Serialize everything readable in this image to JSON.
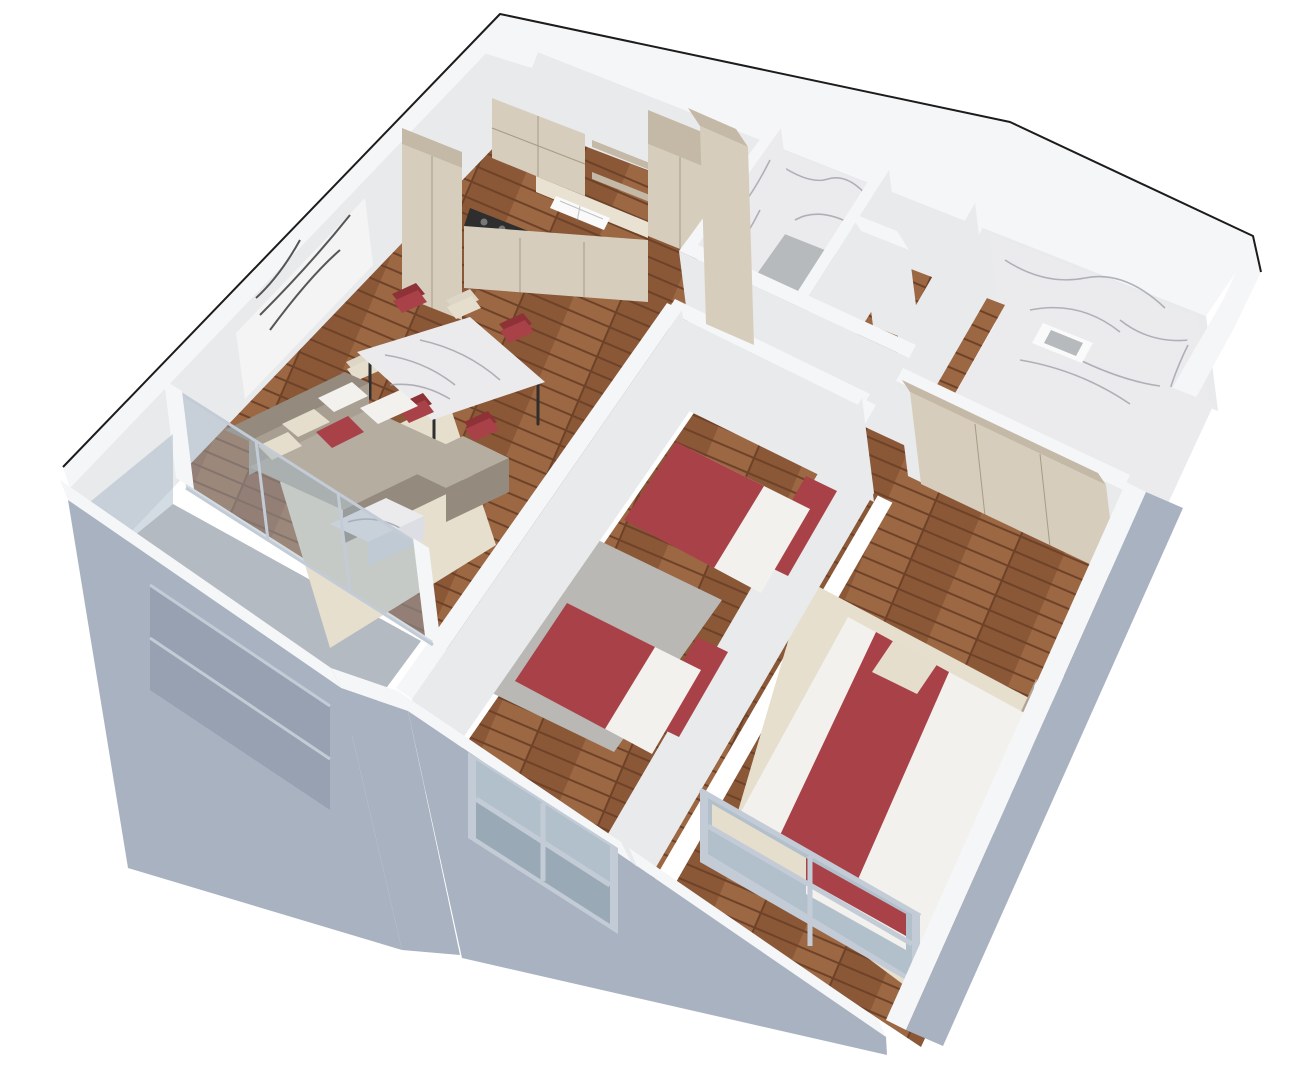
{
  "scene": {
    "title": "3D cutaway floor plan render of a two-bedroom apartment",
    "view": "aerial perspective cutaway, walls cut at ~1.1 m",
    "background": "#ffffff",
    "visible_text": ""
  },
  "palette": {
    "bg": "#ffffff",
    "outline": "#1c1c1c",
    "wall_top": "#f5f6f8",
    "wall_face": "#e9eaec",
    "wall_side": "#dcdee3",
    "facade": "#a9b2c1",
    "facade_shadow": "#97a1b2",
    "glass": "rgba(158,178,192,0.45)",
    "window_frame": "#c3ccd6",
    "wood": "#8a5737",
    "wood2": "#9c6743",
    "wood3": "#6e4228",
    "floor_gray": "#b6babd",
    "concrete": "#b4bac1",
    "marble": "#ebebed",
    "marble_vein": "#9b9ba6",
    "rug_beige": "#e6dfcd",
    "rug_gray": "#b9b8b4",
    "cabinet": "#d7cdbc",
    "cabinet_dark": "#c4b9a6",
    "counter": "#e9e1d2",
    "cream": "#ddd5c6",
    "red": "#a84248",
    "red_dark": "#8e3238",
    "sofa": "#a89f92",
    "sofa_dark": "#948b7e",
    "sofa_light": "#b5ada0",
    "pillow_white": "#f2f1ee",
    "pillow_cream": "#e5decd",
    "bed_frame_taupe": "#b0a394",
    "white_fixture": "#fafafa",
    "black_detail": "#2e2e2e"
  },
  "rooms": [
    {
      "id": "kitchen-living",
      "name": "open plan kitchen / dining / living room",
      "floor": "wood parquet"
    },
    {
      "id": "corridor",
      "name": "corridor",
      "floor": "wood parquet"
    },
    {
      "id": "entry-hall",
      "name": "entry hall",
      "floor": "wood parquet"
    },
    {
      "id": "bathroom-small",
      "name": "small bathroom (WC)",
      "floor": "gray tile",
      "walls": "white marble"
    },
    {
      "id": "bathroom-large",
      "name": "large bathroom",
      "floor": "marble",
      "walls": "white marble"
    },
    {
      "id": "kids-bedroom",
      "name": "bedroom with two single beds",
      "floor": "wood parquet + gray rug"
    },
    {
      "id": "master-bedroom",
      "name": "master bedroom",
      "floor": "wood parquet + beige rug"
    },
    {
      "id": "balcony",
      "name": "balcony with glass balustrade",
      "floor": "concrete"
    }
  ],
  "furniture": [
    {
      "room": "kitchen-living",
      "item": "beige kitchen cabinets, wall units, open shelves, tall unit"
    },
    {
      "room": "kitchen-living",
      "item": "gas cooktop (black)"
    },
    {
      "room": "kitchen-living",
      "item": "double-basin sink"
    },
    {
      "room": "kitchen-living",
      "item": "marble dining table with 6 chairs (4 red, 2 cream)"
    },
    {
      "room": "kitchen-living",
      "item": "gray L-shaped sectional sofa with white, cream and red pillows"
    },
    {
      "room": "kitchen-living",
      "item": "marble coffee table"
    },
    {
      "room": "kitchen-living",
      "item": "black and white abstract wall art"
    },
    {
      "room": "kitchen-living",
      "item": "beige area rug"
    },
    {
      "room": "kids-bedroom",
      "item": "two single beds, red headboards and red blankets, white pillows"
    },
    {
      "room": "kids-bedroom",
      "item": "gray rug"
    },
    {
      "room": "master-bedroom",
      "item": "double bed, white duvet, red throw, four white pillows, beige accent pillow"
    },
    {
      "room": "master-bedroom",
      "item": "round white bedside table"
    },
    {
      "room": "master-bedroom",
      "item": "built-in beige wardrobe"
    },
    {
      "room": "bathroom-small",
      "item": "toilet and wall sink"
    },
    {
      "room": "bathroom-large",
      "item": "square marble sink basin"
    },
    {
      "room": "balcony",
      "item": "glass sliding door and glass balustrade"
    }
  ],
  "openings": [
    {
      "wall": "south facade",
      "item": "french window of kids bedroom with glass balustrade"
    },
    {
      "wall": "south facade",
      "item": "large master bedroom window"
    },
    {
      "wall": "southwest facade",
      "item": "balcony opening"
    }
  ]
}
